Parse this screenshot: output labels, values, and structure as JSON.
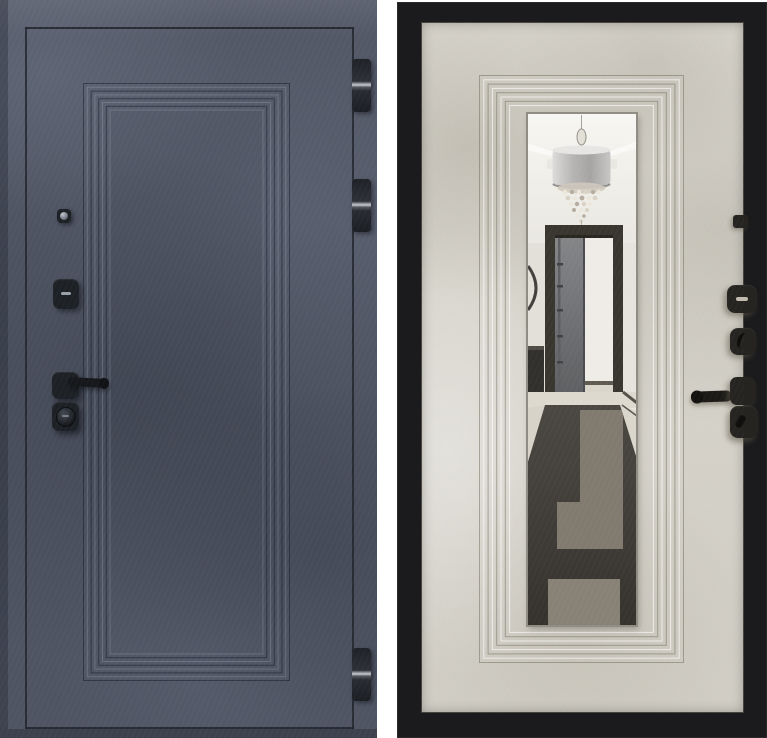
{
  "page": {
    "background": "#ffffff"
  },
  "panels": {
    "left_door": {
      "name": "entry-door-exterior-side",
      "alt": "Dark graphite concrete-textured steel door with stepped rectangular panel, peephole, keyhole cover, black lever handle, lock cylinder and three edge hinges",
      "components": [
        "peephole",
        "keyhole-cover",
        "lever-handle",
        "lock-cylinder",
        "hinge-top",
        "hinge-middle",
        "hinge-bottom"
      ]
    },
    "right_door": {
      "name": "entry-door-interior-side",
      "alt": "Light beige concrete-textured door in black steel frame with stepped moulding around a tall mirror; mirror reflects a hallway with drum chandelier, open dark doorway and patterned dark runner rug; black peephole, lock plates, thumb turn, lever handle and cylinder on the right",
      "components": [
        "peephole",
        "lock-plate",
        "thumb-turn",
        "lever-handle",
        "lock-cylinder",
        "mirror"
      ],
      "mirror_reflection": [
        "ceiling-cove-light",
        "drum-chandelier-with-crystals",
        "open-doorway",
        "open-grey-door",
        "bright-room",
        "marble-floor",
        "dark-geometric-runner-rug",
        "console-silhouette"
      ]
    }
  },
  "colors": {
    "leftBase": "#525866",
    "lineDark": "#1f232b",
    "hw": "#1d2025",
    "hwDark": "#15171b",
    "hingeShine": "#c9cbd0",
    "slotLight": "#9aa0a8",
    "rightFrame": "#1b1b1d",
    "rightPanel": "#d5d2c9",
    "mirrorEdge": "#8f8c83",
    "hwBrown": "#262420",
    "hwSlot": "#c0bbae",
    "ceiling": "#f5f4f0",
    "wall": "#ebe8e1",
    "doorFrame": "#332f29",
    "openDoor": "#6e6f72",
    "opening": "#eeece5",
    "floorLight": "#dcd8ce",
    "rugDark": "#3b3833",
    "rugTaupe": "#7d766b",
    "chandelierShade": "#b9b8b6"
  },
  "ridges": {
    "left": {
      "count": 8,
      "spacing": 3.8,
      "dark": "rgba(24,29,41,0.55)",
      "light": "rgba(195,203,218,0.22)"
    },
    "right": {
      "count": 8,
      "spacing": 4.3,
      "dark": "rgba(108,103,90,0.50)",
      "light": "rgba(255,255,255,0.65)"
    }
  }
}
